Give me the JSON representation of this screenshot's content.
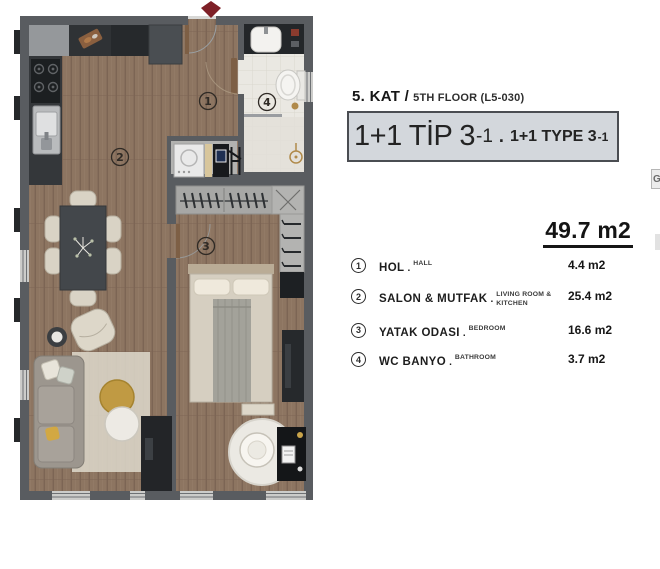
{
  "colors": {
    "accent_red": "#7e2027",
    "wall_gray": "#595c60",
    "wood_floor": "#8d7561",
    "bath_tile": "#eae8e2",
    "type_box_bg": "#d3d7dc"
  },
  "plan": {
    "room_numbers": [
      "1",
      "2",
      "3",
      "4"
    ]
  },
  "panel": {
    "floor_title": "5. KAT /",
    "floor_subtitle": "5TH FLOOR (L5-030)",
    "type_box": {
      "tr_main": "1+1 TİP 3",
      "tr_sub": "-1",
      "separator": ".",
      "en_main": "1+1 TYPE 3",
      "en_sub": "-1"
    },
    "total_area": "49.7 m2",
    "name_separator": ".",
    "legend": [
      {
        "num": "1",
        "name_tr": "HOL",
        "name_en": "HALL",
        "area": "4.4 m2"
      },
      {
        "num": "2",
        "name_tr": "SALON & MUTFAK",
        "name_en": "LIVING ROOM & KITCHEN",
        "area": "25.4 m2"
      },
      {
        "num": "3",
        "name_tr": "YATAK ODASI",
        "name_en": "BEDROOM",
        "area": "16.6 m2"
      },
      {
        "num": "4",
        "name_tr": "WC BANYO",
        "name_en": "BATHROOM",
        "area": "3.7 m2"
      }
    ],
    "edge_fragment": "G"
  }
}
